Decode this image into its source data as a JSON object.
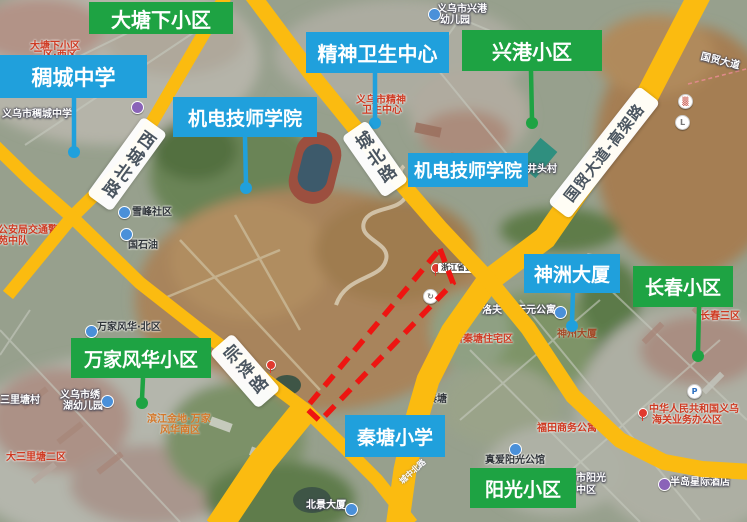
{
  "colors": {
    "annotation_green": "#1EA343",
    "annotation_blue": "#20A0DC",
    "road_overlay_yellow": "#FBBB10",
    "red_zone_outline": "#EE1511",
    "road_label_text": "#4A5560"
  },
  "callouts": [
    {
      "label": "大塘下小区",
      "color": "green"
    },
    {
      "label": "稠城中学",
      "color": "blue"
    },
    {
      "label": "机电技师学院",
      "color": "blue"
    },
    {
      "label": "精神卫生中心",
      "color": "blue"
    },
    {
      "label": "兴港小区",
      "color": "green"
    },
    {
      "label": "机电技师学院",
      "color": "blue"
    },
    {
      "label": "神洲大厦",
      "color": "blue"
    },
    {
      "label": "长春小区",
      "color": "green"
    },
    {
      "label": "万家风华小区",
      "color": "green"
    },
    {
      "label": "秦塘小学",
      "color": "blue"
    },
    {
      "label": "阳光小区",
      "color": "green"
    }
  ],
  "road_labels": [
    {
      "text": "西城北路"
    },
    {
      "text": "城北路"
    },
    {
      "text": "宗泽路"
    },
    {
      "text": "国贸大道-高架路"
    }
  ],
  "basemap_labels": [
    {
      "text": "大塘下小区"
    },
    {
      "text": "二区·西区"
    },
    {
      "text": "义乌市稠城中学"
    },
    {
      "text": "雪峰社区"
    },
    {
      "text": "国石油"
    },
    {
      "text": "义乌市兴港"
    },
    {
      "text": "幼儿园"
    },
    {
      "text": "义乌市精神"
    },
    {
      "text": "卫生中心"
    },
    {
      "text": "井头村"
    },
    {
      "text": "国贸大道"
    },
    {
      "text": "新秦塘住宅区"
    },
    {
      "text": "洛夫"
    },
    {
      "text": "天元公寓"
    },
    {
      "text": "神州大厦"
    },
    {
      "text": "长春三区"
    },
    {
      "text": "福田商务公寓"
    },
    {
      "text": "中华人民共和国义乌"
    },
    {
      "text": "海关业务办公区"
    },
    {
      "text": "秦塘"
    },
    {
      "text": "真爱阳光公馆"
    },
    {
      "text": "市阳光"
    },
    {
      "text": "中区"
    },
    {
      "text": "半岛星际酒店"
    },
    {
      "text": "北景大厦"
    },
    {
      "text": "大三里塘二区"
    },
    {
      "text": "三里塘村"
    },
    {
      "text": "义乌市绣"
    },
    {
      "text": "湖幼儿园"
    },
    {
      "text": "万家风华·北区"
    },
    {
      "text": "滨江金地·万家"
    },
    {
      "text": "风华南区"
    },
    {
      "text": "公安局交通警"
    },
    {
      "text": "苑中队"
    },
    {
      "text": "浙江省金"
    },
    {
      "text": "城中北路"
    }
  ]
}
